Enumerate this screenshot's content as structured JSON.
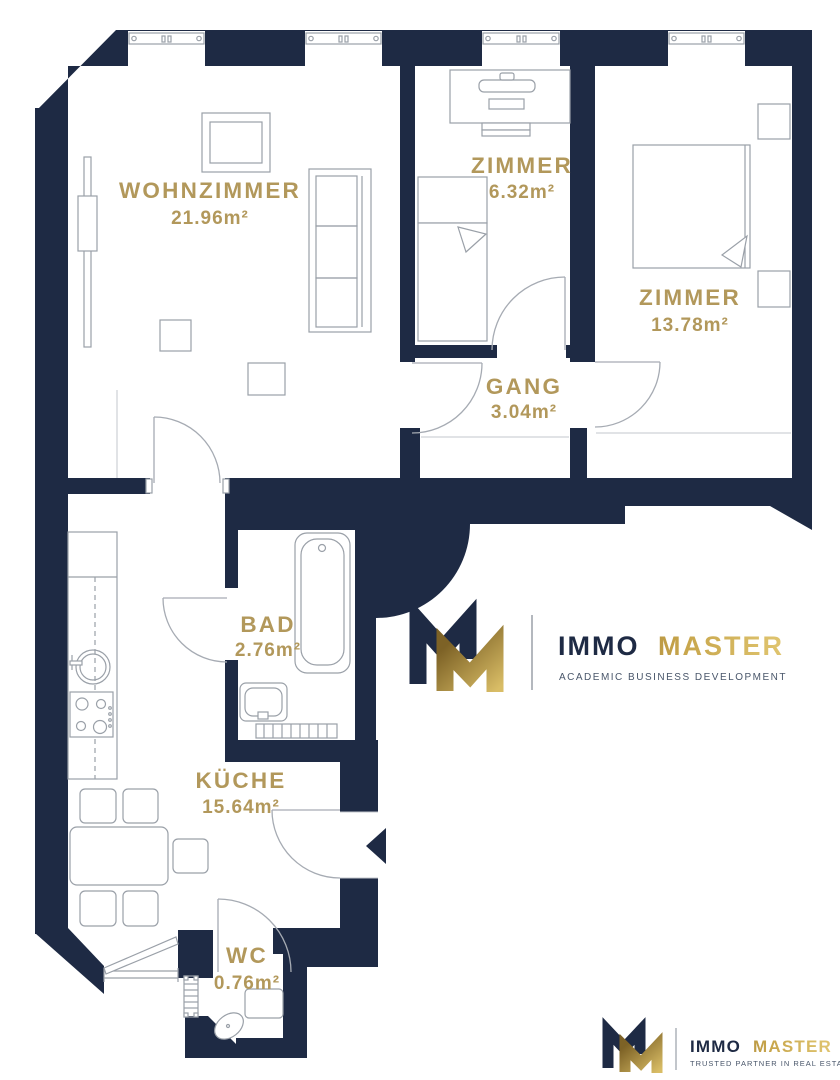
{
  "rooms": [
    {
      "id": "wohnzimmer",
      "name": "WOHNZIMMER",
      "area": "21.96m²"
    },
    {
      "id": "zimmer-klein",
      "name": "ZIMMER",
      "area": "6.32m²"
    },
    {
      "id": "zimmer-gross",
      "name": "ZIMMER",
      "area": "13.78m²"
    },
    {
      "id": "gang",
      "name": "GANG",
      "area": "3.04m²"
    },
    {
      "id": "bad",
      "name": "BAD",
      "area": "2.76m²"
    },
    {
      "id": "kueche",
      "name": "KÜCHE",
      "area": "15.64m²"
    },
    {
      "id": "wc",
      "name": "WC",
      "area": "0.76m²"
    }
  ],
  "branding": {
    "center": {
      "brand_primary": "IMMO",
      "brand_secondary": "MASTER",
      "tagline": "ACADEMIC BUSINESS DEVELOPMENT"
    },
    "footer": {
      "brand_primary": "IMMO",
      "brand_secondary": "MASTER",
      "tagline": "TRUSTED PARTNER IN REAL ESTATE"
    }
  },
  "colors": {
    "wall": "#1e2a44",
    "label_gold": "#b2985b",
    "logo_navy": "#1e2a44",
    "logo_gold": "#c7a54b",
    "line_gray": "#9aa0a8"
  }
}
